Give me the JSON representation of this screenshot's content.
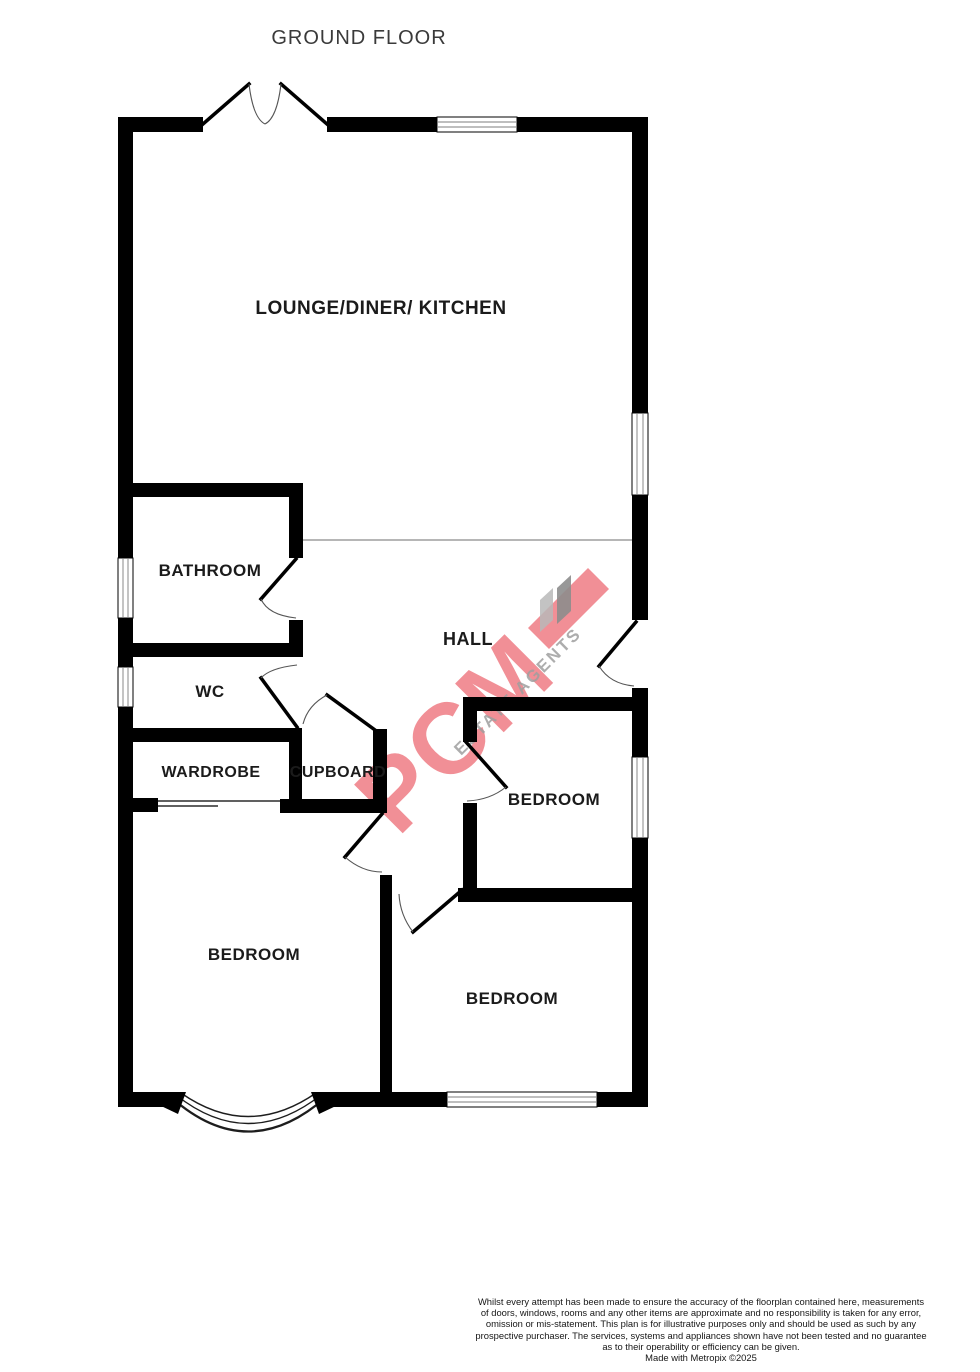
{
  "title": "GROUND FLOOR",
  "rooms": {
    "lounge": "LOUNGE/DINER/ KITCHEN",
    "bathroom": "BATHROOM",
    "wc": "WC",
    "wardrobe": "WARDROBE",
    "cupboard": "CUPBOARD",
    "hall": "HALL",
    "bedroom_top_right": "BEDROOM",
    "bedroom_bottom_left": "BEDROOM",
    "bedroom_bottom_right": "BEDROOM"
  },
  "watermark": {
    "brand": "PCM",
    "tagline": "ESTATE AGENTS"
  },
  "footer": {
    "lines": [
      "Whilst every attempt has been made to ensure the accuracy of the floorplan contained here, measurements",
      "of doors, windows, rooms and any other items are approximate and no responsibility is taken for any error,",
      "omission or mis-statement. This plan is for illustrative purposes only and should be used as such by any",
      "prospective purchaser. The services, systems and appliances shown have not been tested and no guarantee",
      "as to their operability or efficiency can be given."
    ],
    "credit": "Made with Metropix ©2025"
  },
  "colors": {
    "wall": "#000000",
    "label": "#1b1b1b",
    "watermark_red": "#e84450",
    "watermark_grey": "#9f9f9f"
  }
}
